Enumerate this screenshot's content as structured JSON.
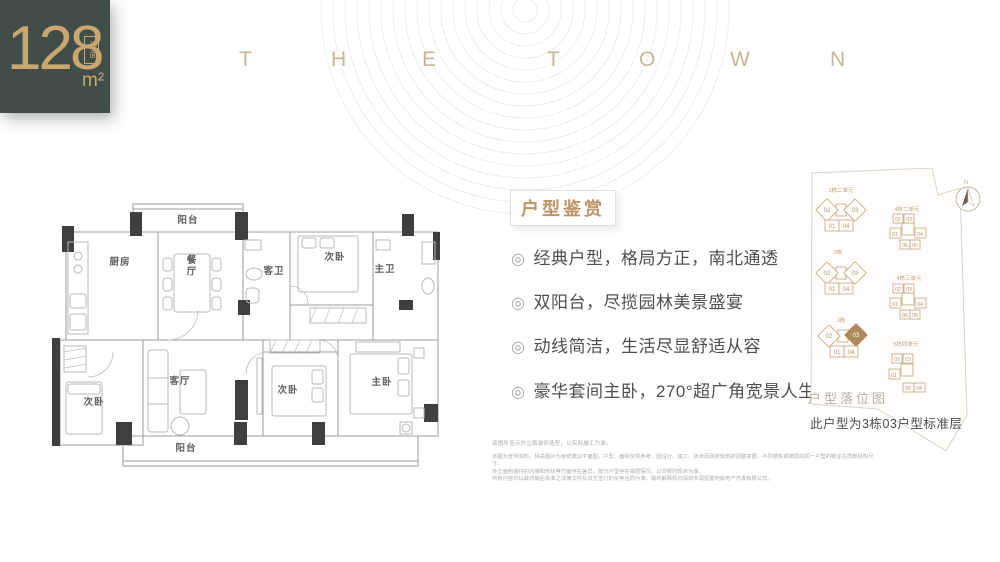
{
  "badge": {
    "value": "128",
    "unit": "m²",
    "seal": "建面"
  },
  "brand": {
    "name": "THE TOWN",
    "letters": [
      "T",
      "H",
      "E",
      "T",
      "O",
      "W",
      "N"
    ]
  },
  "floorplan": {
    "rooms": {
      "balcony_top": "阳台",
      "kitchen": "厨房",
      "dining": "餐厅",
      "guest_bath": "客卫",
      "bedroom_top": "次卧",
      "master_bath": "主卫",
      "bedroom_left": "次卧",
      "living": "客厅",
      "bedroom_mid": "次卧",
      "master_bedroom": "主卧",
      "balcony_bottom": "阳台"
    }
  },
  "highlights": {
    "title": "户型鉴赏",
    "bullet": "◎",
    "items": [
      "经典户型，格局方正，南北通透",
      "双阳台，尽揽园林美景盛宴",
      "动线简洁，生活尽显舒适从容",
      "豪华套间主卧，270°超广角宽景人生"
    ]
  },
  "siteplan": {
    "title": "户型落位图",
    "caption": "此户型为3栋03户型标准层",
    "compass": "N",
    "clusters": [
      {
        "label": "1栋二单元",
        "units": [
          "02",
          "03",
          "01",
          "04"
        ]
      },
      {
        "label": "2栋",
        "units": [
          "02",
          "03",
          "01",
          "04"
        ]
      },
      {
        "label": "3栋",
        "units": [
          "02",
          "03",
          "01",
          "04"
        ],
        "highlighted": "03"
      },
      {
        "label": "4栋二单元",
        "units": [
          "02",
          "03",
          "01",
          "04",
          "06",
          "05"
        ]
      },
      {
        "label": "4栋三单元",
        "units": [
          "02",
          "03",
          "01",
          "04",
          "06",
          "05"
        ]
      },
      {
        "label": "5栋四单元",
        "units": [
          "02",
          "03",
          "01",
          "05",
          "04"
        ]
      }
    ]
  },
  "disclaimer": {
    "line1": "该图所显示外立面装饰造型，以实际施工为准。",
    "para1": "本图为宣传资料，相关图片为装修建议平面图，户型、面积仅供参考，因设计、施工、技术及政府规划的调整变更，不同楼栋或楼层的同一户型的物业在局部结构尺寸、",
    "para2": "外立面构造柱的内墙和形状等方面存在差异，部分户型存在错层情况，以交楼时现状为准。",
    "para3": "所有内容均以政府最后批准之法律文件及双方签订的买卖合同为准，最终解释权归深圳市润恒置地房地产开发有限公司。"
  }
}
